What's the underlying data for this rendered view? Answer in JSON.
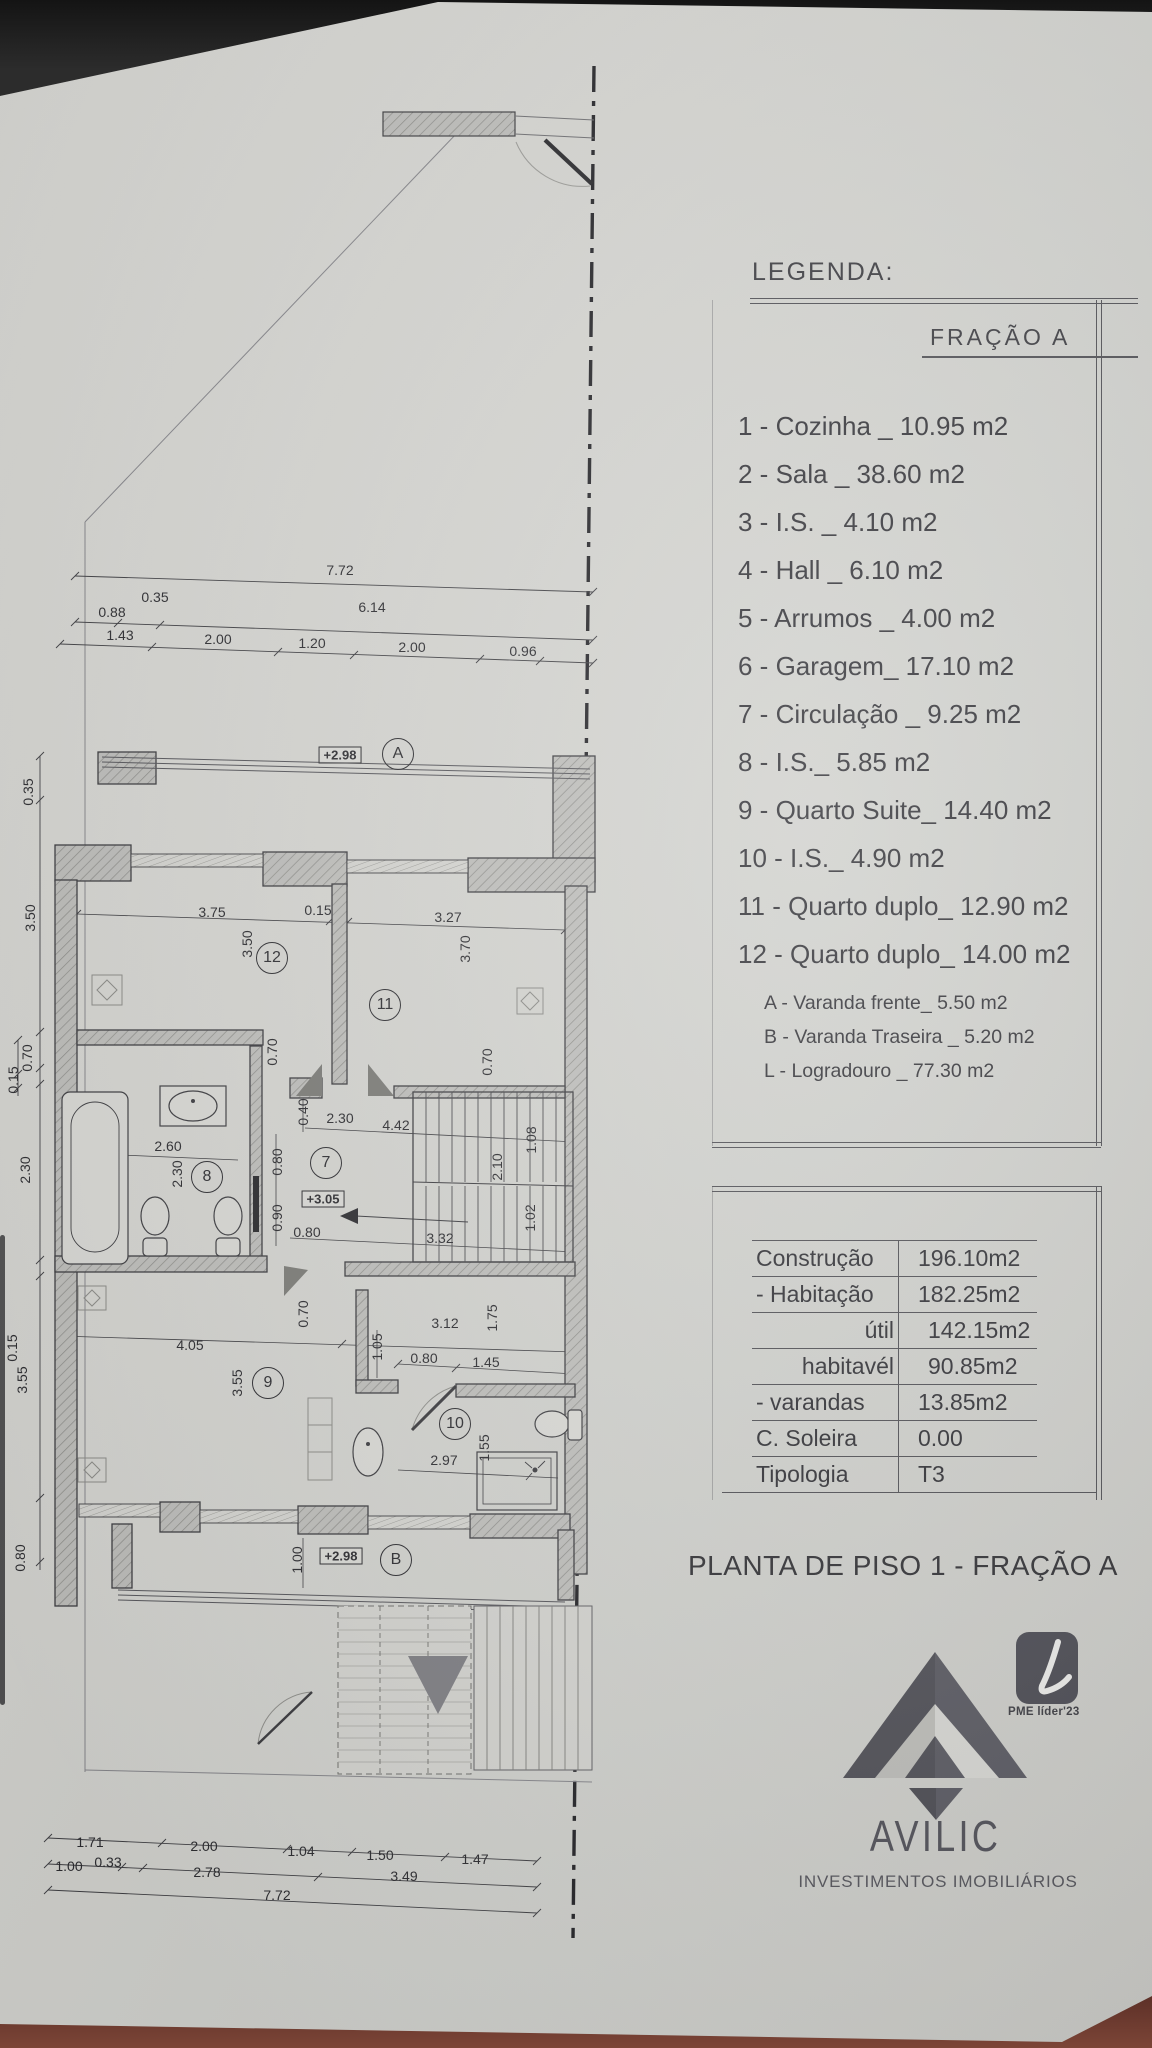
{
  "legend": {
    "title": "LEGENDA:",
    "fraction_title": "FRAÇÃO A",
    "items": [
      "1 - Cozinha _ 10.95 m2",
      "2 - Sala  _ 38.60 m2",
      "3 - I.S. _ 4.10 m2",
      "4 - Hall _ 6.10 m2",
      "5 - Arrumos _ 4.00 m2",
      "6 - Garagem_ 17.10 m2",
      "7 - Circulação _ 9.25 m2",
      "8 - I.S._ 5.85 m2",
      "9 - Quarto Suite_ 14.40 m2",
      "10 - I.S._ 4.90 m2",
      "11 - Quarto duplo_ 12.90 m2",
      "12 - Quarto duplo_ 14.00 m2"
    ],
    "sub_items": [
      "A - Varanda frente_ 5.50 m2",
      "B - Varanda Traseira _ 5.20 m2",
      "L - Logradouro _ 77.30 m2"
    ]
  },
  "areas_table": {
    "rows": [
      {
        "label": "Construção",
        "value": "196.10m2"
      },
      {
        "label": "- Habitação",
        "value": "182.25m2"
      },
      {
        "label": "útil",
        "value": "142.15m2"
      },
      {
        "label": "habitavél",
        "value": "90.85m2"
      },
      {
        "label": "- varandas",
        "value": "13.85m2"
      },
      {
        "label": "C. Soleira",
        "value": "0.00"
      },
      {
        "label": "Tipologia",
        "value": "T3"
      }
    ]
  },
  "title": "PLANTA DE PISO 1 - FRAÇÃO A",
  "logo": {
    "name": "AVILIC",
    "subtitle": "INVESTIMENTOS IMOBILIÁRIOS",
    "badge": "PME líder'23"
  },
  "colors": {
    "paper": "#d4d4d0",
    "ink": "#2d2d31",
    "wall_gray": "#bfbfbc",
    "logo_gray": "#57575e",
    "badge_bg": "#4a4a52",
    "table_surface": "#6e3b30"
  },
  "plan": {
    "labels": [
      {
        "t": "7.72",
        "x": 340,
        "y": 570
      },
      {
        "t": "0.88",
        "x": 112,
        "y": 612
      },
      {
        "t": "0.35",
        "x": 155,
        "y": 597
      },
      {
        "t": "6.14",
        "x": 372,
        "y": 607
      },
      {
        "t": "1.43",
        "x": 120,
        "y": 635
      },
      {
        "t": "2.00",
        "x": 218,
        "y": 639
      },
      {
        "t": "1.20",
        "x": 312,
        "y": 643
      },
      {
        "t": "2.00",
        "x": 412,
        "y": 647
      },
      {
        "t": "0.96",
        "x": 523,
        "y": 651
      },
      {
        "t": "0.35",
        "x": 28,
        "y": 792,
        "k": "v"
      },
      {
        "t": "3.50",
        "x": 30,
        "y": 918,
        "k": "v"
      },
      {
        "t": "0.70",
        "x": 27,
        "y": 1058,
        "k": "v"
      },
      {
        "t": "0.15",
        "x": 13,
        "y": 1080,
        "k": "v"
      },
      {
        "t": "2.30",
        "x": 25,
        "y": 1170,
        "k": "v"
      },
      {
        "t": "0.15",
        "x": 12,
        "y": 1348,
        "k": "v"
      },
      {
        "t": "3.55",
        "x": 22,
        "y": 1380,
        "k": "v"
      },
      {
        "t": "0.80",
        "x": 20,
        "y": 1558,
        "k": "v"
      },
      {
        "t": "+2.98",
        "x": 340,
        "y": 755,
        "k": "b"
      },
      {
        "t": "A",
        "x": 398,
        "y": 754,
        "k": "c"
      },
      {
        "t": "3.75",
        "x": 212,
        "y": 912
      },
      {
        "t": "0.15",
        "x": 318,
        "y": 910
      },
      {
        "t": "3.27",
        "x": 448,
        "y": 917
      },
      {
        "t": "3.50",
        "x": 247,
        "y": 944,
        "k": "v"
      },
      {
        "t": "3.70",
        "x": 465,
        "y": 949,
        "k": "v"
      },
      {
        "t": "12",
        "x": 272,
        "y": 958,
        "k": "c"
      },
      {
        "t": "11",
        "x": 385,
        "y": 1005,
        "k": "c"
      },
      {
        "t": "0.70",
        "x": 272,
        "y": 1052,
        "k": "v"
      },
      {
        "t": "0.70",
        "x": 487,
        "y": 1062,
        "k": "v"
      },
      {
        "t": "2.60",
        "x": 168,
        "y": 1146
      },
      {
        "t": "2.30",
        "x": 177,
        "y": 1174,
        "k": "v"
      },
      {
        "t": "8",
        "x": 207,
        "y": 1177,
        "k": "c"
      },
      {
        "t": "0.40",
        "x": 303,
        "y": 1112,
        "k": "v"
      },
      {
        "t": "2.30",
        "x": 340,
        "y": 1118
      },
      {
        "t": "4.42",
        "x": 396,
        "y": 1125
      },
      {
        "t": "0.80",
        "x": 277,
        "y": 1162,
        "k": "v"
      },
      {
        "t": "7",
        "x": 326,
        "y": 1163,
        "k": "c"
      },
      {
        "t": "+3.05",
        "x": 323,
        "y": 1199,
        "k": "b"
      },
      {
        "t": "0.90",
        "x": 277,
        "y": 1218,
        "k": "v"
      },
      {
        "t": "0.80",
        "x": 307,
        "y": 1232
      },
      {
        "t": "3.32",
        "x": 440,
        "y": 1238
      },
      {
        "t": "2.10",
        "x": 497,
        "y": 1167,
        "k": "v"
      },
      {
        "t": "1.08",
        "x": 531,
        "y": 1140,
        "k": "v"
      },
      {
        "t": "1.02",
        "x": 530,
        "y": 1218,
        "k": "v"
      },
      {
        "t": "4.05",
        "x": 190,
        "y": 1345
      },
      {
        "t": "0.70",
        "x": 303,
        "y": 1314,
        "k": "v"
      },
      {
        "t": "3.55",
        "x": 237,
        "y": 1383,
        "k": "v"
      },
      {
        "t": "9",
        "x": 268,
        "y": 1383,
        "k": "c"
      },
      {
        "t": "3.12",
        "x": 445,
        "y": 1323
      },
      {
        "t": "1.05",
        "x": 377,
        "y": 1347,
        "k": "v"
      },
      {
        "t": "1.75",
        "x": 492,
        "y": 1318,
        "k": "v"
      },
      {
        "t": "0.80",
        "x": 424,
        "y": 1358
      },
      {
        "t": "1.45",
        "x": 486,
        "y": 1362
      },
      {
        "t": "10",
        "x": 455,
        "y": 1424,
        "k": "c"
      },
      {
        "t": "2.97",
        "x": 444,
        "y": 1460
      },
      {
        "t": "1.55",
        "x": 484,
        "y": 1448,
        "k": "v"
      },
      {
        "t": "1.00",
        "x": 297,
        "y": 1560,
        "k": "v"
      },
      {
        "t": "+2.98",
        "x": 341,
        "y": 1556,
        "k": "b"
      },
      {
        "t": "B",
        "x": 396,
        "y": 1560,
        "k": "c"
      },
      {
        "t": "1.71",
        "x": 90,
        "y": 1842
      },
      {
        "t": "2.00",
        "x": 204,
        "y": 1846
      },
      {
        "t": "1.04",
        "x": 301,
        "y": 1851
      },
      {
        "t": "1.50",
        "x": 380,
        "y": 1855
      },
      {
        "t": "1.47",
        "x": 475,
        "y": 1859
      },
      {
        "t": "1.00",
        "x": 69,
        "y": 1866
      },
      {
        "t": "0.33",
        "x": 108,
        "y": 1862
      },
      {
        "t": "2.78",
        "x": 207,
        "y": 1872
      },
      {
        "t": "3.49",
        "x": 404,
        "y": 1876
      },
      {
        "t": "7.72",
        "x": 277,
        "y": 1895
      }
    ]
  }
}
